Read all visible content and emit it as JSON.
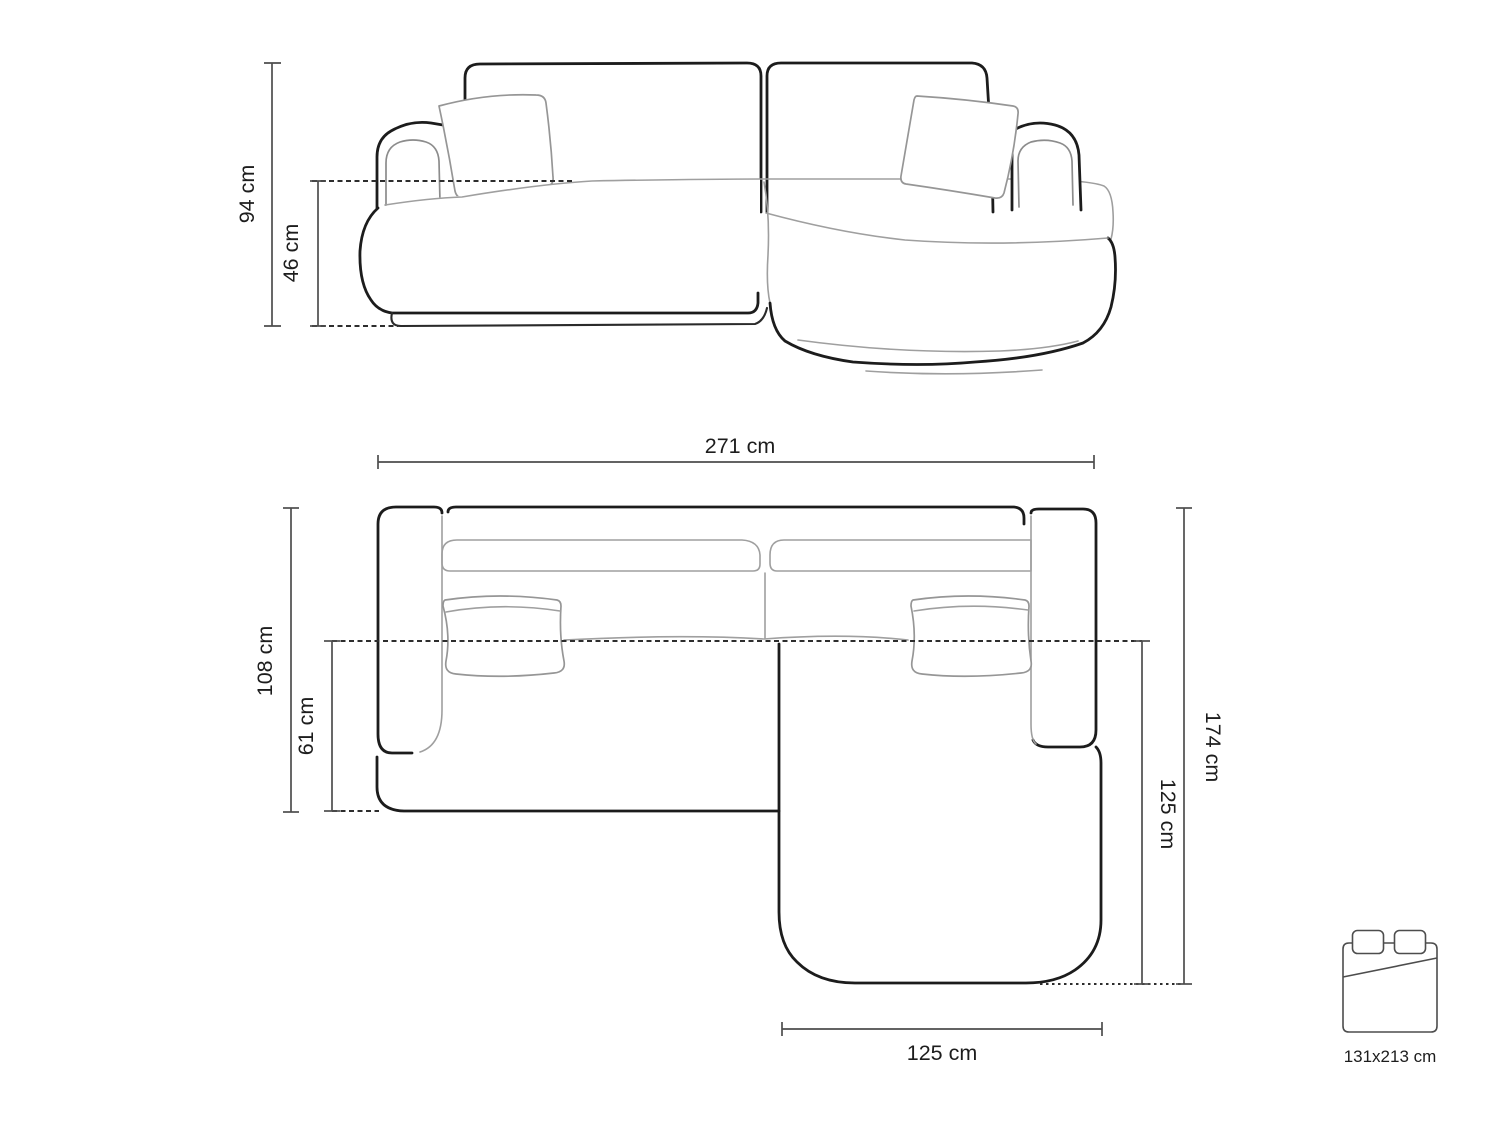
{
  "diagram_title": "corner-sofa-dimension-diagram",
  "colors": {
    "background": "#ffffff",
    "outline": "#1c1c1c",
    "soft_line": "#9f9f9f",
    "dimension_line": "#4d4d4d",
    "text": "#1d1d1d"
  },
  "front_view": {
    "height_label": "94 cm",
    "seat_height_label": "46 cm"
  },
  "top_view": {
    "width_label": "271 cm",
    "depth_label": "108 cm",
    "seat_depth_label": "61 cm",
    "length_label": "174 cm",
    "chaise_length_label": "125 cm",
    "chaise_width_label": "125 cm"
  },
  "sleeping_area": {
    "size_label": "131x213 cm"
  }
}
